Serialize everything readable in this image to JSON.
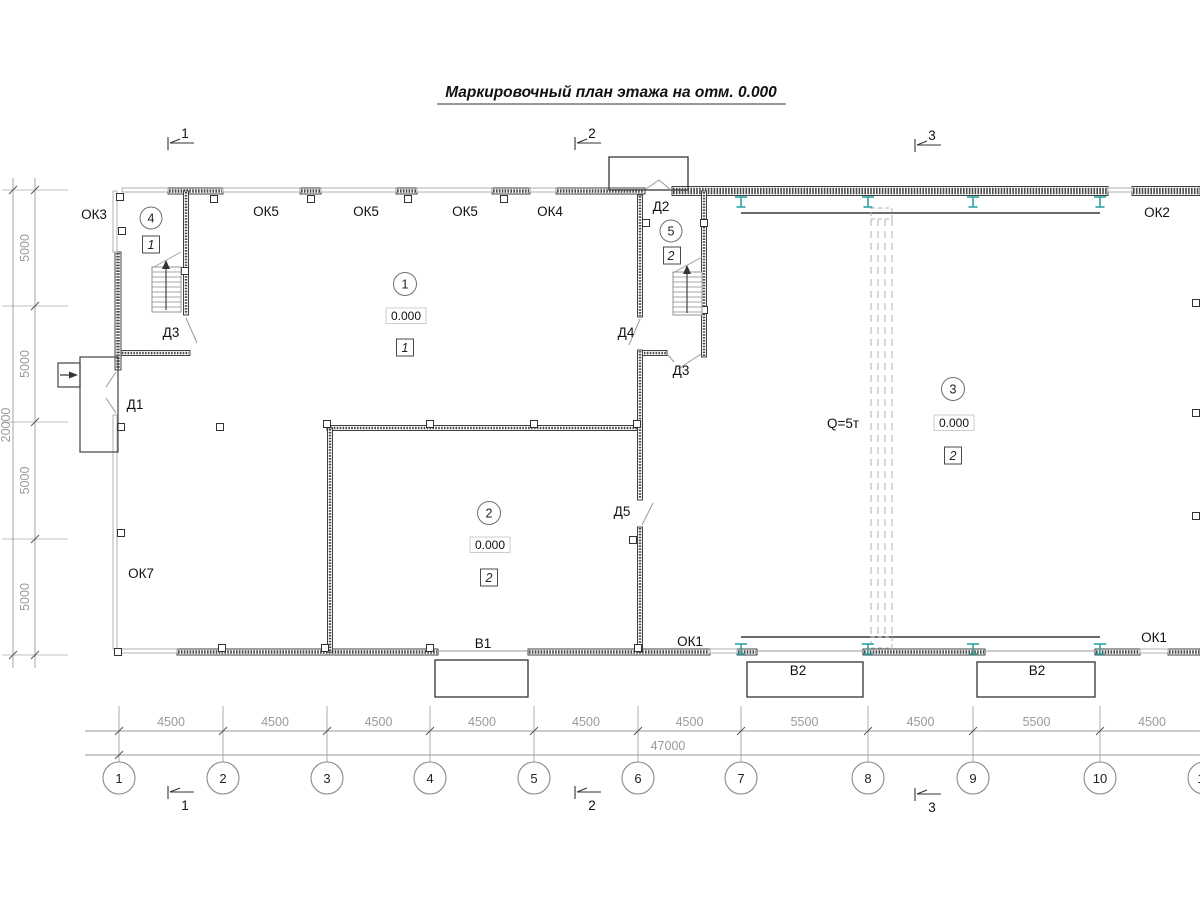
{
  "title": "Маркировочный план этажа на отм. 0.000",
  "section_markers": {
    "top": [
      "1",
      "2",
      "3"
    ],
    "bottom": [
      "1",
      "2",
      "3"
    ]
  },
  "grid": {
    "bubbles": [
      "1",
      "2",
      "3",
      "4",
      "5",
      "6",
      "7",
      "8",
      "9",
      "10",
      "11"
    ],
    "dims": [
      "4500",
      "4500",
      "4500",
      "4500",
      "4500",
      "4500",
      "5500",
      "4500",
      "5500",
      "4500"
    ],
    "total": "47000",
    "left_dims": [
      "5000",
      "5000",
      "5000",
      "5000"
    ],
    "left_total": "20000"
  },
  "windows": {
    "ok1": "ОК1",
    "ok2": "ОК2",
    "ok3": "ОК3",
    "ok4": "ОК4",
    "ok5": "ОК5",
    "ok7": "ОК7"
  },
  "doors": {
    "d1": "Д1",
    "d2": "Д2",
    "d3": "Д3",
    "d4": "Д4",
    "d5": "Д5"
  },
  "gates": {
    "v1": "В1",
    "v2": "В2"
  },
  "rooms": [
    {
      "num": "1",
      "elevation": "0.000",
      "category": "1"
    },
    {
      "num": "2",
      "elevation": "0.000",
      "category": "2"
    },
    {
      "num": "3",
      "elevation": "0.000",
      "category": "2"
    },
    {
      "num": "4",
      "category": "1"
    },
    {
      "num": "5",
      "category": "2"
    }
  ],
  "crane": {
    "capacity": "Q=5т"
  },
  "colors": {
    "wall": "#3f3f3f",
    "thin_wall": "#a8a8a8",
    "dimension": "#9a9a9a",
    "crane_column": "#2FA3A3",
    "text": "#111111"
  }
}
